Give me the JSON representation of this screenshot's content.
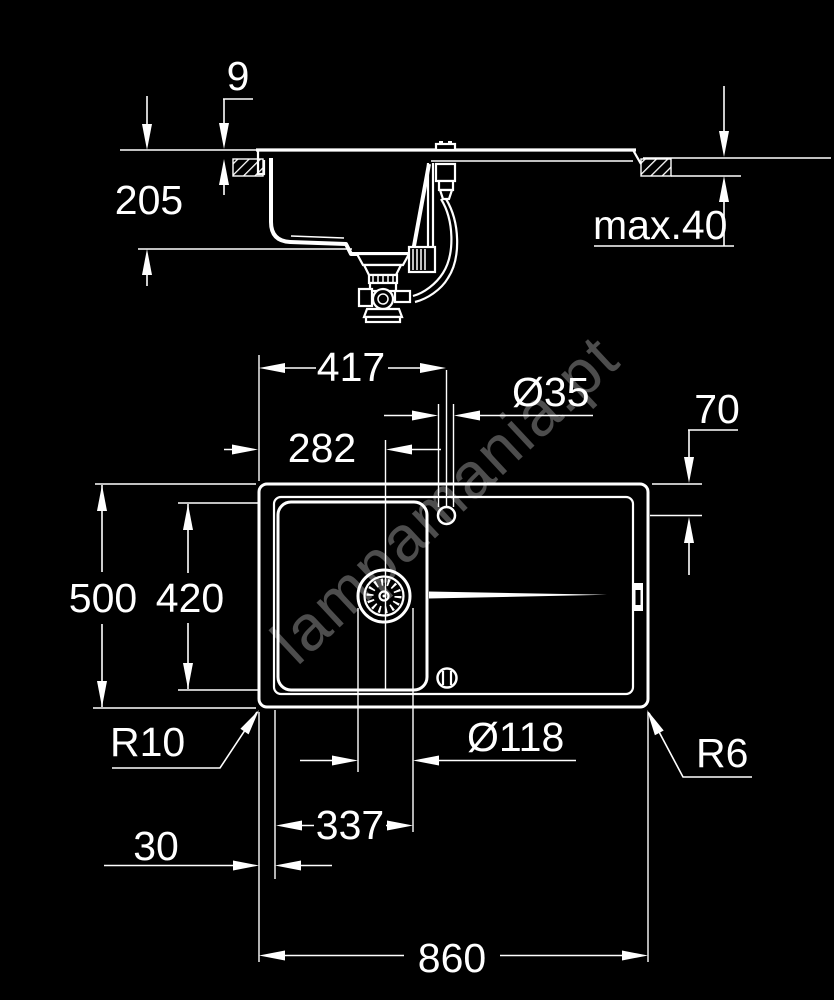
{
  "watermark": "lampamania.pt",
  "colors": {
    "background": "#000000",
    "line": "#ffffff"
  },
  "drawing": {
    "kind": "kitchen sink installation drawing, two views",
    "side_view_dimensions": [
      {
        "meaning": "rim height above counter",
        "value": "9"
      },
      {
        "meaning": "bowl depth",
        "value": "205"
      },
      {
        "meaning": "max counter thickness",
        "value": "max.40"
      }
    ],
    "plan_view_dimensions": [
      {
        "meaning": "left edge to tap hole centre",
        "value": "417"
      },
      {
        "meaning": "tap hole diameter",
        "value": "Ø35"
      },
      {
        "meaning": "left edge to bowl centre",
        "value": "282"
      },
      {
        "meaning": "top edge to tap hole centre",
        "value": "70"
      },
      {
        "meaning": "overall depth",
        "value": "500"
      },
      {
        "meaning": "bowl cut-out depth",
        "value": "420"
      },
      {
        "meaning": "outer corner radius",
        "value": "R10"
      },
      {
        "meaning": "drain diameter",
        "value": "Ø118"
      },
      {
        "meaning": "inner corner radius",
        "value": "R6"
      },
      {
        "meaning": "edge to inner rim",
        "value": "30"
      },
      {
        "meaning": "inner edge to drain tangent",
        "value": "337"
      },
      {
        "meaning": "overall width",
        "value": "860"
      }
    ]
  },
  "labels": {
    "d9": "9",
    "d205": "205",
    "max40": "max.40",
    "d417": "417",
    "d35": "Ø35",
    "d282": "282",
    "d70": "70",
    "d500": "500",
    "d420": "420",
    "r10": "R10",
    "d118": "Ø118",
    "r6": "R6",
    "d337": "337",
    "d30": "30",
    "d860": "860"
  }
}
